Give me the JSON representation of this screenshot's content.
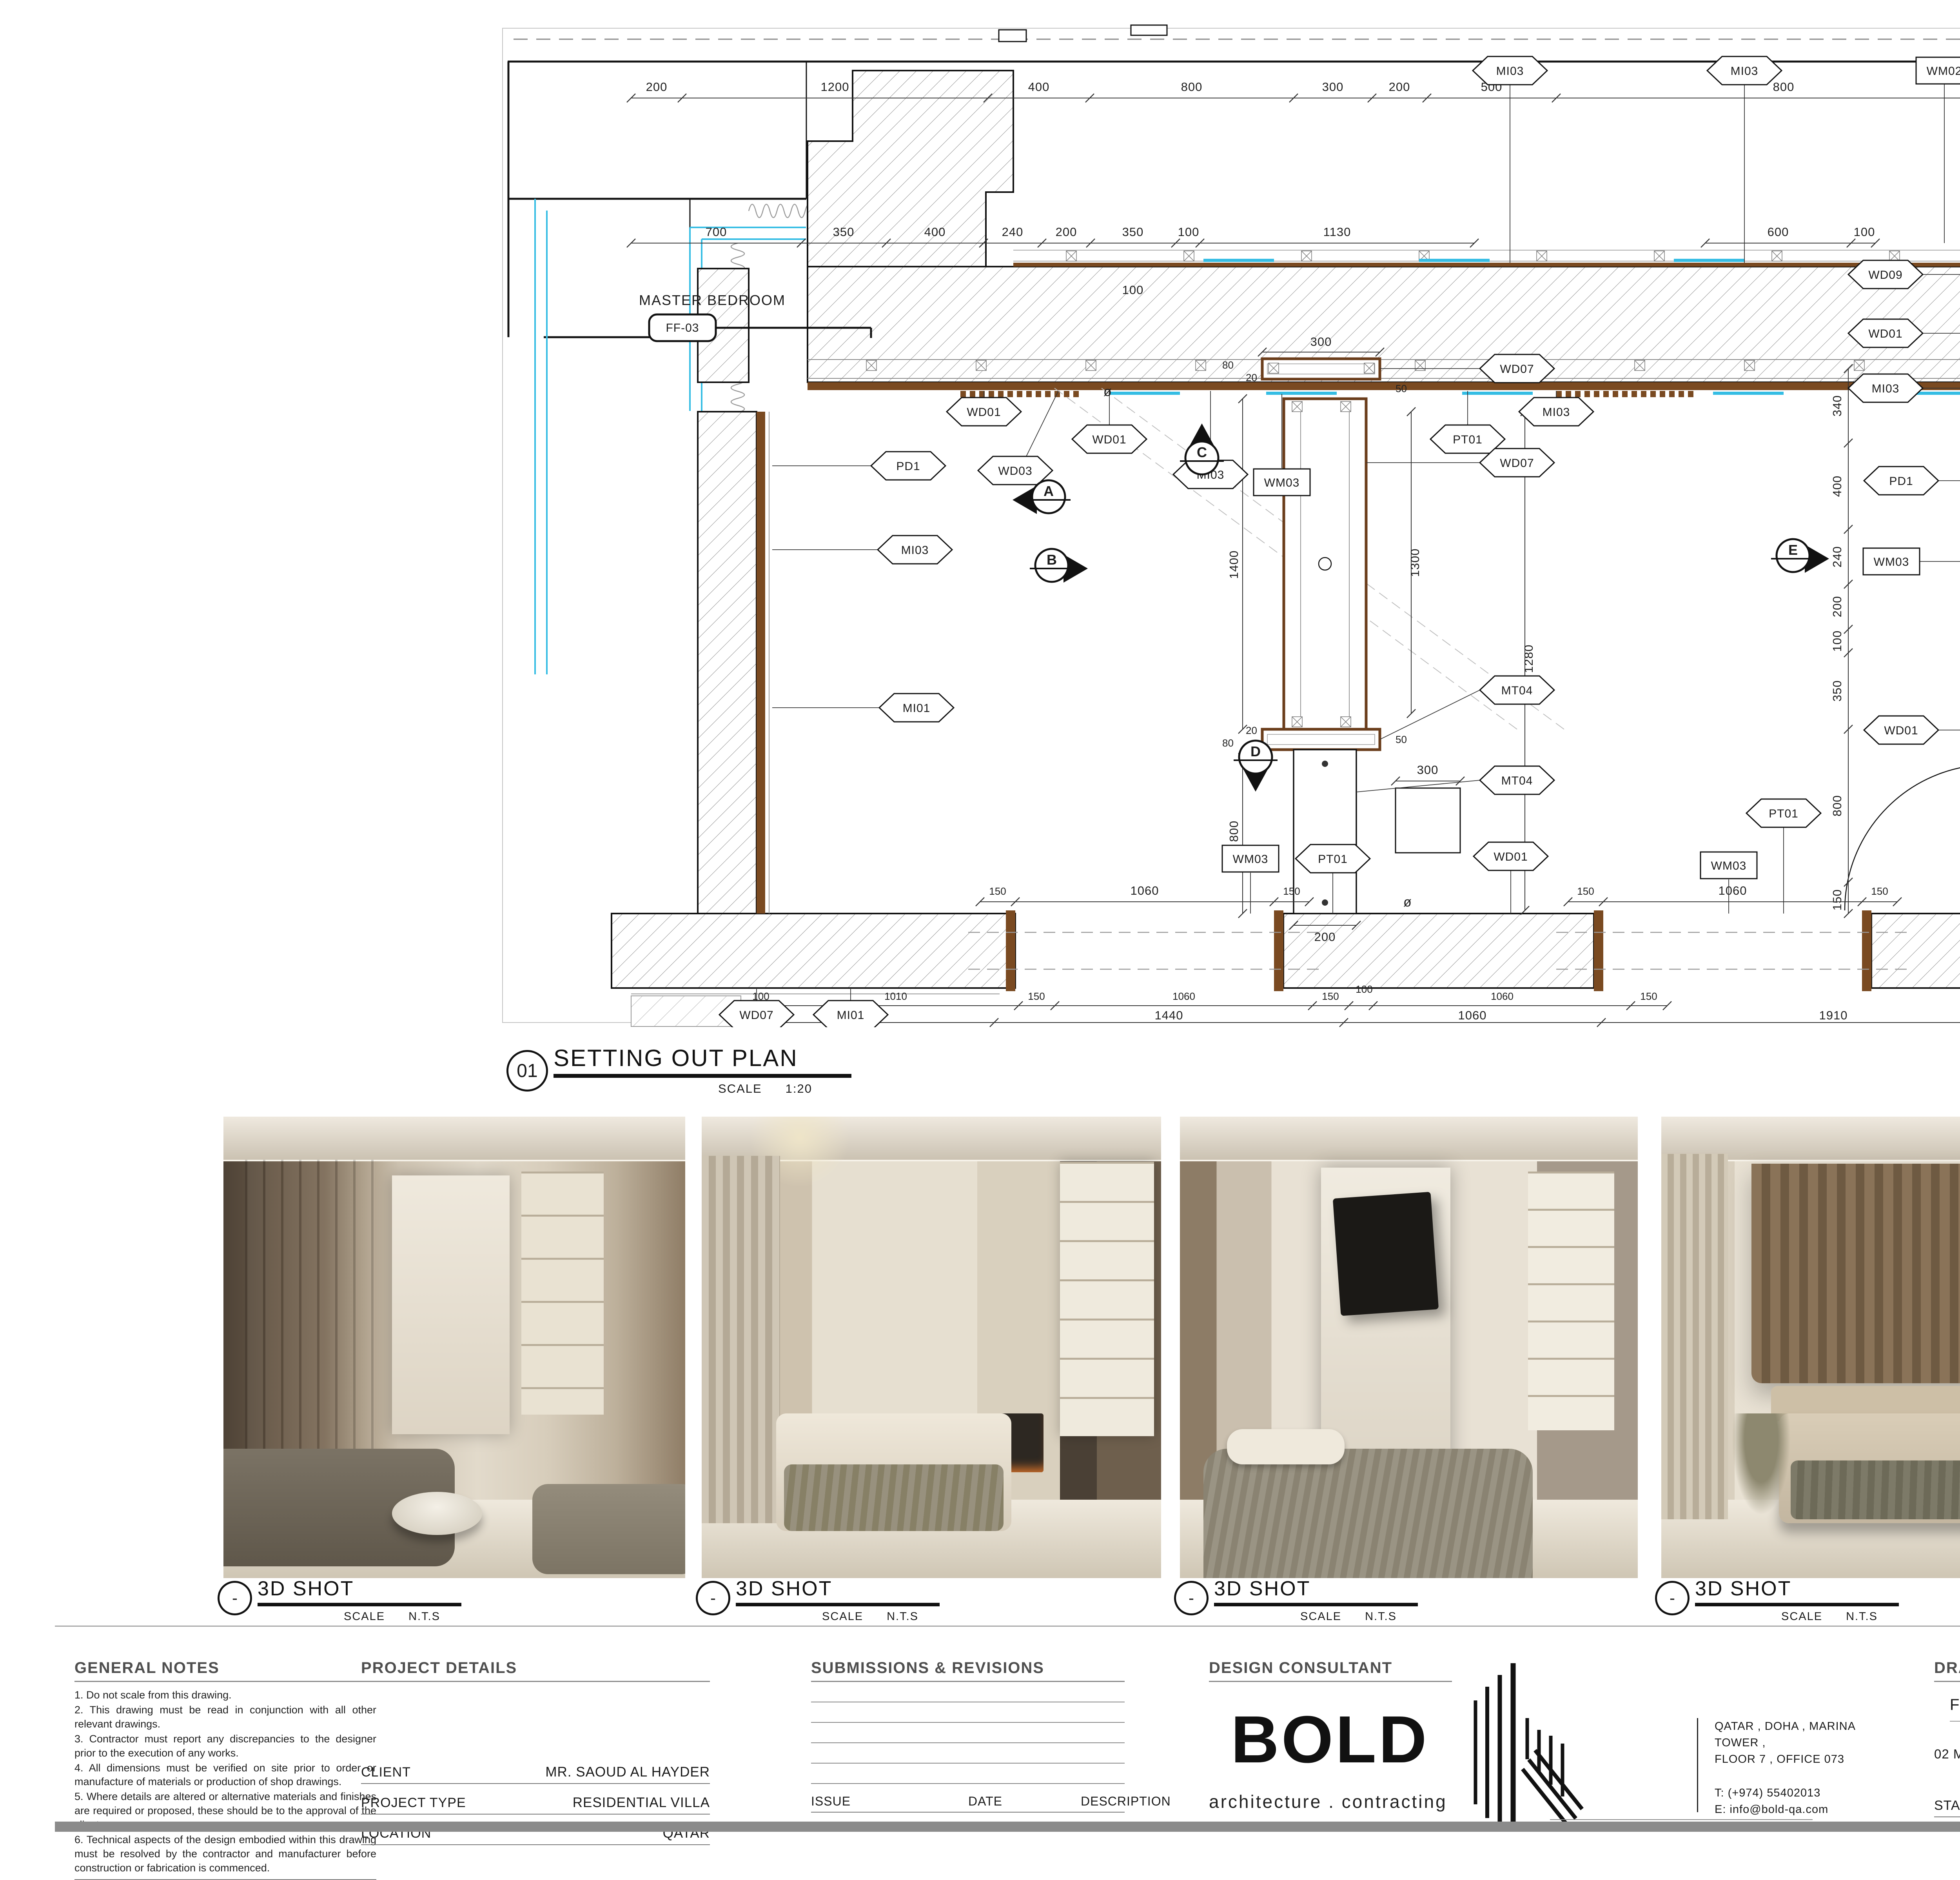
{
  "plan": {
    "room_label": "MASTER BEDROOM",
    "room_tag": "FF-03",
    "caption": {
      "num": "01",
      "title": "SETTING OUT PLAN",
      "scale_label": "SCALE",
      "scale": "1:20"
    },
    "markers": {
      "a": "A",
      "b": "B",
      "c": "C",
      "d": "D",
      "e": "E"
    },
    "misc": {
      "outlet": "ø"
    },
    "tags": [
      "WD01",
      "WD01",
      "WD03",
      "MI03",
      "PT01",
      "MI03",
      "MI03",
      "MI03",
      "WM02",
      "WD09",
      "WD01",
      "MI03",
      "PD1",
      "WM03",
      "WD01",
      "WD07",
      "WD07",
      "MT04",
      "MT04",
      "WD07",
      "MI01",
      "WM03",
      "PT01",
      "WD01",
      "WM03",
      "PT01",
      "PD1",
      "MI03",
      "MI01",
      "DR01",
      "WM03"
    ],
    "dims": {
      "top": [
        "200",
        "1200",
        "400",
        "800",
        "300",
        "200",
        "500",
        "800",
        "100"
      ],
      "upper": [
        "700",
        "350",
        "400",
        "240",
        "200",
        "350",
        "100",
        "1130",
        "600",
        "100"
      ],
      "upper_float": "100",
      "right_inner": [
        "340",
        "400",
        "240",
        "200",
        "100",
        "350",
        "800",
        "150"
      ],
      "right_outer": [
        "650",
        "200",
        "100",
        "550"
      ],
      "right_far": [
        "2240",
        "960"
      ],
      "part": {
        "w": "300",
        "hl": "1400",
        "hr": "1300",
        "f50a": "50",
        "f50b": "50",
        "f80a": "80",
        "f20a": "20",
        "f20b": "20",
        "f80b": "80",
        "col": "800",
        "colw": "200",
        "long": "1280",
        "box": "300"
      },
      "bottom_in": [
        "150",
        "1060",
        "150",
        "150",
        "1060",
        "150"
      ],
      "bottom_mid": [
        "100",
        "1010",
        "150",
        "1060",
        "150",
        "100",
        "1060",
        "150"
      ],
      "bottom_low": [
        "1010",
        "1440",
        "1060",
        "1910"
      ]
    }
  },
  "panels": [
    {
      "title": "3D SHOT",
      "ref": "-",
      "scale_label": "SCALE",
      "scale": "N.T.S"
    },
    {
      "title": "3D SHOT",
      "ref": "-",
      "scale_label": "SCALE",
      "scale": "N.T.S"
    },
    {
      "title": "3D SHOT",
      "ref": "-",
      "scale_label": "SCALE",
      "scale": "N.T.S"
    },
    {
      "title": "3D SHOT",
      "ref": "-",
      "scale_label": "SCALE",
      "scale": "N.T.S"
    },
    {
      "title": "KEY PLAN",
      "ref": "-",
      "scale_label": "SCALE",
      "scale": "N.T.S"
    }
  ],
  "titleblock": {
    "general_notes": {
      "header": "GENERAL NOTES",
      "notes": [
        "1.      Do not scale from this drawing.",
        "2.      This drawing must be read in conjunction with all other relevant drawings.",
        "3.      Contractor must report any discrepancies to the designer prior to the execution of any works.",
        "4.      All dimensions must be verified on site prior to order or manufacture of materials or production of shop drawings.",
        "5.      Where details are altered or alternative materials and finishes are required or proposed, these should be to the approval of the client.",
        "6.      Technical aspects of the design embodied within this drawing must be resolved by the contractor and manufacturer before construction or fabrication is commenced."
      ]
    },
    "project_details": {
      "header": "PROJECT DETAILS",
      "rows": [
        {
          "label": "CLIENT",
          "value": "MR.   SAOUD AL HAYDER"
        },
        {
          "label": "PROJECT TYPE",
          "value": "RESIDENTIAL VILLA"
        },
        {
          "label": "LOCATION",
          "value": "QATAR"
        }
      ]
    },
    "submissions": {
      "header": "SUBMISSIONS & REVISIONS",
      "col1": "ISSUE",
      "col2": "DATE",
      "col3": "DESCRIPTION"
    },
    "consultant": {
      "header": "DESIGN CONSULTANT",
      "brand": "BOLD",
      "brand_sub": "architecture . contracting",
      "address_line1": "QATAR , DOHA , MARINA TOWER ,",
      "address_line2": "FLOOR 7 ,  OFFICE 073",
      "phone": "T: (+974) 55402013",
      "email": "E: info@bold-qa.com"
    },
    "drawing_title": {
      "header": "DRAWING TITLE",
      "floor": "FIRST FLOOR",
      "title": "02 MASTER BEDROOM - SETTING OUT PLAN",
      "stage_label": "STAGE",
      "stage_value": "WORKING DRAWINGS"
    },
    "info": {
      "header": "INFO",
      "rows": [
        {
          "label": "PROJECT NO.",
          "value": "169-02021"
        },
        {
          "label": "DRAWING NO.",
          "value": "ID-169-02021-FF-500.22"
        },
        {
          "label": "SCALE",
          "value": "1:20  AT A1"
        },
        {
          "label": "DATE",
          "value": "13.06.2024"
        },
        {
          "label": "DRAWN BY",
          "value": ""
        },
        {
          "label": "CHECKED BY",
          "value": ""
        }
      ]
    },
    "colors": {
      "glazing": "#35bde4",
      "millwork": "#7a4a21",
      "highlight": "#cc1111"
    }
  }
}
